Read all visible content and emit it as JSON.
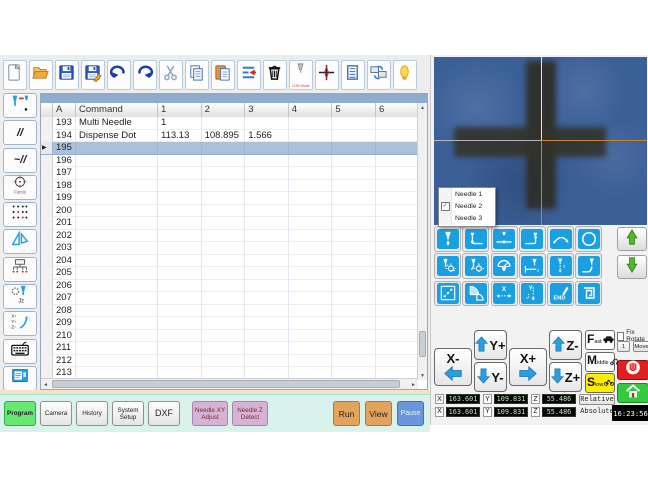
{
  "colors": {
    "accent_blue": "#1a9fe0",
    "selected_row": "#a9c2da",
    "slow_yellow": "#ffee00",
    "run_orange": "#e2a45c",
    "pause_blue": "#6b96d9",
    "program_green": "#66e873",
    "pink_button": "#d6b3d6",
    "camera_blue": "#3b5f97",
    "crosshair_orange": "#c8862c"
  },
  "toolbar": {
    "buttons": [
      {
        "name": "new"
      },
      {
        "name": "open"
      },
      {
        "name": "save"
      },
      {
        "name": "save-as"
      },
      {
        "name": "undo"
      },
      {
        "name": "redo"
      },
      {
        "name": "cut"
      },
      {
        "name": "copy"
      },
      {
        "name": "paste"
      },
      {
        "name": "insert-delete-line"
      },
      {
        "name": "delete"
      },
      {
        "name": "cob-mode",
        "label": "COB Mode"
      },
      {
        "name": "crosshair"
      },
      {
        "name": "log"
      },
      {
        "name": "screen-sync"
      },
      {
        "name": "work-lamp"
      }
    ]
  },
  "sidebar": {
    "buttons": [
      {
        "name": "needle-tool"
      },
      {
        "name": "parallel-line",
        "glyph": "//"
      },
      {
        "name": "wave-line",
        "glyph": "~//"
      },
      {
        "name": "focus",
        "label": "Focus"
      },
      {
        "name": "dot-matrix"
      },
      {
        "name": "set-square"
      },
      {
        "name": "array-tree"
      },
      {
        "name": "needle-gear-jz"
      },
      {
        "name": "xyz-adjust"
      },
      {
        "name": "keyboard"
      },
      {
        "name": "screen-view"
      }
    ]
  },
  "program_table": {
    "columns": [
      "",
      "A",
      "Command",
      "1",
      "2",
      "3",
      "4",
      "5",
      "6"
    ],
    "selected_row": "195",
    "rows": [
      {
        "a": "193",
        "command": "Multi Needle",
        "v": [
          "1",
          "",
          "",
          "",
          "",
          ""
        ]
      },
      {
        "a": "194",
        "command": "Dispense Dot",
        "v": [
          "113.13",
          "108.895",
          "1.566",
          "",
          "",
          ""
        ]
      },
      {
        "a": "195",
        "command": "",
        "v": [
          "",
          "",
          "",
          "",
          "",
          ""
        ]
      },
      {
        "a": "196",
        "command": "",
        "v": [
          "",
          "",
          "",
          "",
          "",
          ""
        ]
      },
      {
        "a": "197",
        "command": "",
        "v": [
          "",
          "",
          "",
          "",
          "",
          ""
        ]
      },
      {
        "a": "198",
        "command": "",
        "v": [
          "",
          "",
          "",
          "",
          "",
          ""
        ]
      },
      {
        "a": "199",
        "command": "",
        "v": [
          "",
          "",
          "",
          "",
          "",
          ""
        ]
      },
      {
        "a": "200",
        "command": "",
        "v": [
          "",
          "",
          "",
          "",
          "",
          ""
        ]
      },
      {
        "a": "201",
        "command": "",
        "v": [
          "",
          "",
          "",
          "",
          "",
          ""
        ]
      },
      {
        "a": "202",
        "command": "",
        "v": [
          "",
          "",
          "",
          "",
          "",
          ""
        ]
      },
      {
        "a": "203",
        "command": "",
        "v": [
          "",
          "",
          "",
          "",
          "",
          ""
        ]
      },
      {
        "a": "204",
        "command": "",
        "v": [
          "",
          "",
          "",
          "",
          "",
          ""
        ]
      },
      {
        "a": "205",
        "command": "",
        "v": [
          "",
          "",
          "",
          "",
          "",
          ""
        ]
      },
      {
        "a": "206",
        "command": "",
        "v": [
          "",
          "",
          "",
          "",
          "",
          ""
        ]
      },
      {
        "a": "207",
        "command": "",
        "v": [
          "",
          "",
          "",
          "",
          "",
          ""
        ]
      },
      {
        "a": "208",
        "command": "",
        "v": [
          "",
          "",
          "",
          "",
          "",
          ""
        ]
      },
      {
        "a": "209",
        "command": "",
        "v": [
          "",
          "",
          "",
          "",
          "",
          ""
        ]
      },
      {
        "a": "210",
        "command": "",
        "v": [
          "",
          "",
          "",
          "",
          "",
          ""
        ]
      },
      {
        "a": "211",
        "command": "",
        "v": [
          "",
          "",
          "",
          "",
          "",
          ""
        ]
      },
      {
        "a": "212",
        "command": "",
        "v": [
          "",
          "",
          "",
          "",
          "",
          ""
        ]
      },
      {
        "a": "213",
        "command": "",
        "v": [
          "",
          "",
          "",
          "",
          "",
          ""
        ]
      }
    ]
  },
  "camera": {
    "needle_menu": {
      "items": [
        {
          "label": "Needle 1",
          "checked": false
        },
        {
          "label": "Needle 2",
          "checked": true
        },
        {
          "label": "Needle 3",
          "checked": false
        }
      ]
    }
  },
  "command_grid": {
    "buttons": [
      "dispense-dot",
      "line-start",
      "line-passing",
      "line-end",
      "arc",
      "circle",
      "dot-setup",
      "line-setup",
      "dispense-gauge",
      "z-clearance",
      "needle-z-path",
      "needle-curve",
      "dot-array",
      "fan-area",
      "x-offset",
      "y-offset",
      "end-command",
      "spiral"
    ]
  },
  "jog": {
    "x_minus": "X-",
    "x_plus": "X+",
    "y_plus": "Y+",
    "y_minus": "Y-",
    "z_minus": "Z-",
    "z_plus": "Z+"
  },
  "speed": {
    "fast": "Fast",
    "middle": "Middle",
    "slow": "Slow",
    "selected": "Slow"
  },
  "rotate_panel": {
    "fix_rotate": "Fix Rotate",
    "step": "1",
    "move": "Move"
  },
  "coordinates": {
    "rows": [
      {
        "x": "163.601",
        "y": "109.831",
        "z": "55.486",
        "mode": "Relative"
      },
      {
        "x": "163.601",
        "y": "109.831",
        "z": "55.486",
        "mode": "Absolute"
      }
    ]
  },
  "clock": "16:23:56",
  "nav_tabs": [
    {
      "label": "Program",
      "kind": "green",
      "left": 4,
      "width": 32
    },
    {
      "label": "Camera",
      "kind": "plain",
      "left": 40,
      "width": 32
    },
    {
      "label": "History",
      "kind": "plain",
      "left": 76,
      "width": 32
    },
    {
      "label": "System\nSetup",
      "kind": "plain",
      "left": 112,
      "width": 32
    },
    {
      "label": "DXF",
      "kind": "plain dxf",
      "left": 148,
      "width": 32
    },
    {
      "label": "Needle XY\nAdjust",
      "kind": "pink",
      "left": 192,
      "width": 36
    },
    {
      "label": "Needle Z\nDetect",
      "kind": "pink",
      "left": 232,
      "width": 36
    }
  ],
  "run_controls": [
    {
      "label": "Run",
      "kind": "orange",
      "left": 333,
      "width": 27
    },
    {
      "label": "View",
      "kind": "orange",
      "left": 365,
      "width": 27
    },
    {
      "label": "Pause",
      "kind": "blue",
      "left": 397,
      "width": 27
    }
  ]
}
